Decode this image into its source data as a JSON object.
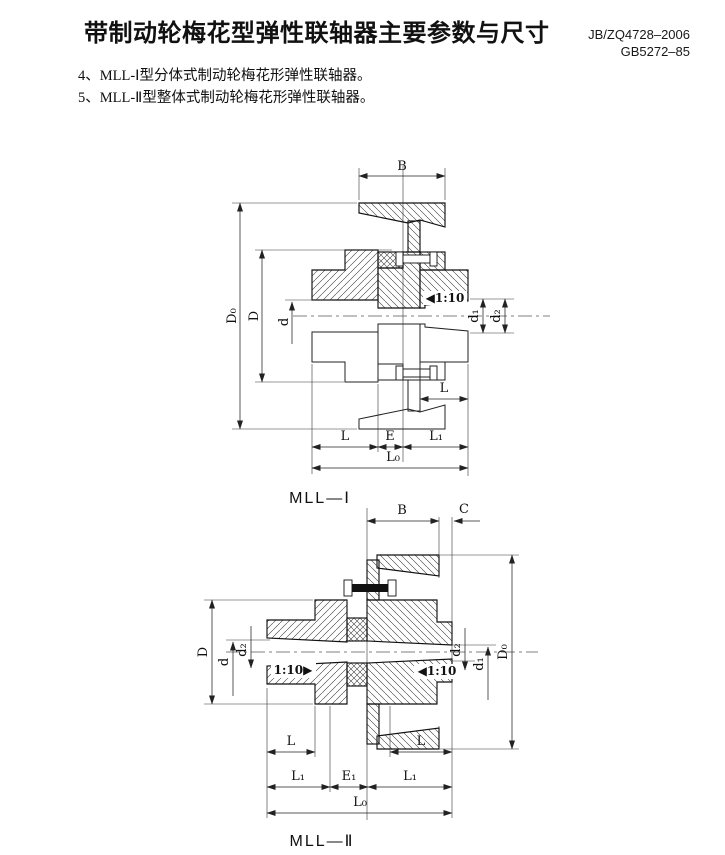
{
  "page": {
    "title": "带制动轮梅花型弹性联轴器主要参数与尺寸",
    "standards": [
      "JB/ZQ4728–2006",
      "GB5272–85"
    ],
    "items": [
      "4、MLL-Ⅰ型分体式制动轮梅花形弹性联轴器。",
      "5、MLL-Ⅱ型整体式制动轮梅花形弹性联轴器。"
    ]
  },
  "drawing1": {
    "caption": "MLL—Ⅰ",
    "labels": {
      "B": "B",
      "D0": "D₀",
      "D": "D",
      "d": "d",
      "taper": "◀1:10",
      "d1": "d₁",
      "d2": "d₂",
      "L": "L",
      "E": "E",
      "L1": "L₁",
      "L0": "L₀"
    }
  },
  "drawing2": {
    "caption": "MLL—Ⅱ",
    "labels": {
      "B": "B",
      "C": "C",
      "D0": "D₀",
      "D": "D",
      "d": "d",
      "d1": "d₁",
      "d2": "d₂",
      "taper_left": "1:10▶",
      "taper_right": "◀1:10",
      "L": "L",
      "E1": "E₁",
      "L1": "L₁",
      "L0": "L₀"
    }
  }
}
